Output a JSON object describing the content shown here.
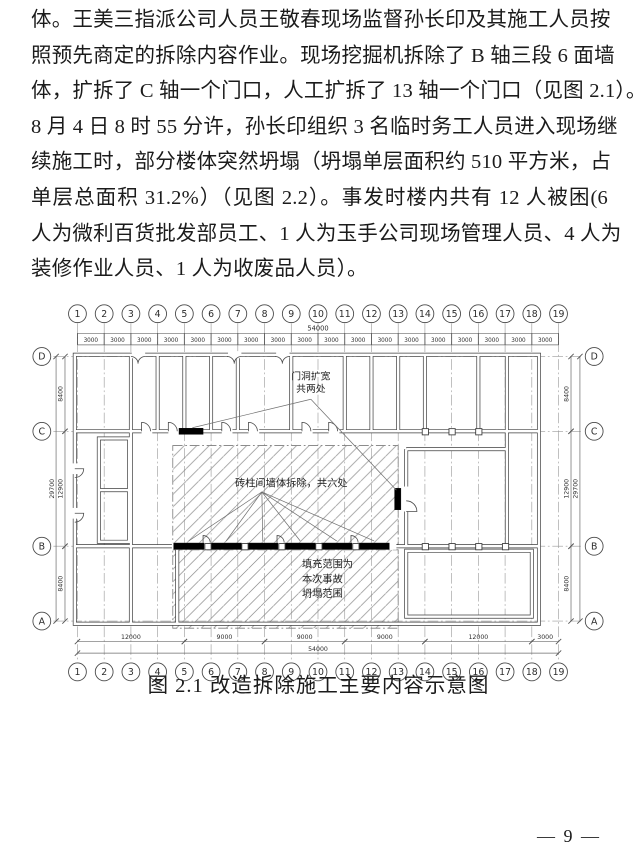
{
  "article": {
    "paragraph_lines": [
      "体。王美三指派公司人员王敬春现场监督孙长印及其施工人员按",
      "照预先商定的拆除内容作业。现场挖掘机拆除了 B 轴三段 6 面墙",
      "体，扩拆了 C 轴一个门口，人工扩拆了 13 轴一个门口（见图 2.1）。",
      "8 月 4 日 8 时 55 分许，孙长印组织 3 名临时务工人员进入现场继",
      "续施工时，部分楼体突然坍塌（坍塌单层面积约 510 平方米，占",
      "单层总面积 31.2%）（见图 2.2）。事发时楼内共有 12 人被困(6",
      "人为微利百货批发部员工、1 人为玉手公司现场管理人员、4 人为",
      "装修作业人员、1 人为收废品人员）。"
    ]
  },
  "figure": {
    "caption": "图 2.1 改造拆除施工主要内容示意图"
  },
  "footer": {
    "page_number": "— 9 —"
  },
  "diagram": {
    "column_axes": [
      "1",
      "2",
      "3",
      "4",
      "5",
      "6",
      "7",
      "8",
      "9",
      "10",
      "11",
      "12",
      "13",
      "14",
      "15",
      "16",
      "17",
      "18",
      "19"
    ],
    "row_axes": [
      "D",
      "C",
      "B",
      "A"
    ],
    "dims": {
      "top_total": "54000",
      "top_segment": "3000",
      "bottom_total": "54000",
      "bottom_spans": [
        [
          "1",
          "5",
          "12000"
        ],
        [
          "5",
          "8",
          "9000"
        ],
        [
          "8",
          "11",
          "9000"
        ],
        [
          "11",
          "14",
          "9000"
        ],
        [
          "14",
          "18",
          "12000"
        ],
        [
          "18",
          "19",
          "3000"
        ]
      ],
      "side_total": "29700",
      "side_spans": [
        [
          "D",
          "C",
          "8400"
        ],
        [
          "C",
          "B",
          "12900"
        ],
        [
          "B",
          "A",
          "8400"
        ]
      ]
    },
    "annotations": {
      "door_widen": [
        "门洞扩宽",
        "共两处"
      ],
      "wall_demolish": "砖柱间墙体拆除，共六处",
      "collapse_range": [
        "填充范围为",
        "本次事故",
        "坍塌范围"
      ]
    }
  }
}
